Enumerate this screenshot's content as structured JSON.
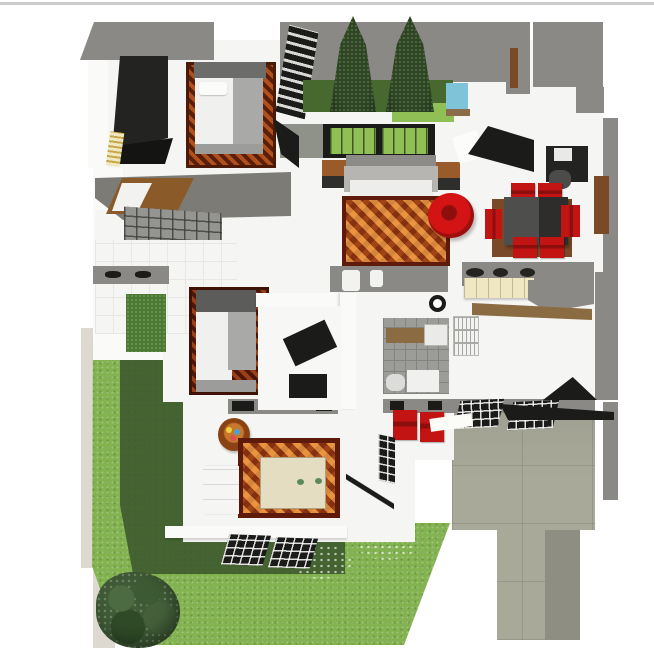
{
  "page": {
    "title": "3D house floor plan rendering",
    "description": "Bird's-eye axonometric render of a single-story house plan with furnished rooms, inner courtyard, garden lawn and driveway. No text is rendered in the image."
  },
  "colors": {
    "hairline": "#cccccc",
    "wallGray": "#8b8985",
    "wallGrayDark": "#7d7b76",
    "wallGreenGray": "#8f9289",
    "wallWhite": "#fafaf8",
    "floorWhite": "#f5f5f3",
    "floorTile": "#e7e7e3",
    "sidewalk": "#ddd9d0",
    "lawnLight": "#83b251",
    "lawnDark": "#47682f",
    "lawnShadow": "#3d5a2e",
    "grassCourtLight": "#8fbf55",
    "treeDark": "#2c4423",
    "treeDarker": "#1e3118",
    "pool": "#7fc3d9",
    "poolEdge": "#8a6b4a",
    "black": "#1b1b19",
    "charcoal": "#232321",
    "wardrobeSide": "#141412",
    "bedFrame": "#9c9c9a",
    "bedHead": "#6c6c6a",
    "mattress": "#f0f0ee",
    "blanket": "#a9a9a7",
    "rugRust": "#7a2c10",
    "rugOrange": "#b2491a",
    "rugBorder": "#5e1b0b",
    "sofaBack": "#8d8b88",
    "sofaBody": "#b7b5b2",
    "sofaSeat": "#ededeb",
    "woodBrown": "#9a5b2b",
    "deckBrown": "#8a5a28",
    "shelfBrown": "#8a6b42",
    "doorBrown": "#7a4a26",
    "matBrown": "#7a4a28",
    "red": "#c31414",
    "redDark": "#8e0e0e",
    "diningTableL": "#4e4e4c",
    "diningTableR": "#2f2d2b",
    "creamCounter": "#efe6c2",
    "applianceWhite": "#f2f2f0",
    "tileGray": "#9c9c98",
    "tileLine": "#83837f",
    "taupe": "#a9a99a",
    "taupeShadow": "#8e8e82",
    "bedCream": "#e5ddc2",
    "benchWhite": "#f5f5f3",
    "greenPatch": "#4c7a33",
    "bushGreen": "#3f5a36",
    "railGray": "#949490",
    "stripeGold": "#c8a84a"
  },
  "scene": {
    "rooms": [
      {
        "name": "bedroom-top-left",
        "contents": [
          "dark wardrobe",
          "double bed with white mattress and gray blanket",
          "rust patterned rug",
          "striped radiator"
        ]
      },
      {
        "name": "inner-courtyard",
        "contents": [
          "two conifer trees",
          "dark lawn strip",
          "light grass",
          "small blue pool",
          "dark trellis shelf"
        ]
      },
      {
        "name": "living-room",
        "contents": [
          "gray sofa with white seat",
          "two wooden side tables",
          "ornate orange rug",
          "round red armchair",
          "two windows with garden view",
          "black media unit",
          "desk with chair"
        ]
      },
      {
        "name": "dining-area",
        "contents": [
          "dark two-tone dining table",
          "six red chairs",
          "brown floor mat",
          "brown door in right wall"
        ]
      },
      {
        "name": "kitchen",
        "contents": [
          "gray counter band with three dark burners",
          "cream cabinet front",
          "gray corner worktop",
          "wooden shelf",
          "stacked white appliances"
        ]
      },
      {
        "name": "bathroom",
        "contents": [
          "gray tiled floor",
          "wooden bench",
          "white shower tray",
          "toilet",
          "washbasin",
          "black ring fixture"
        ]
      },
      {
        "name": "bedroom-middle",
        "contents": [
          "double bed with white mattress",
          "dark red rug",
          "walk-in closet with open black door",
          "black floor mat"
        ]
      },
      {
        "name": "light-well",
        "contents": [
          "small green planted courtyard",
          "gray wall with two dark vents"
        ]
      },
      {
        "name": "master-bedroom",
        "contents": [
          "large ornate orange rug",
          "cream platform bed with two green cushions",
          "white bench",
          "round wooden side table with flowers",
          "open door swing line"
        ]
      },
      {
        "name": "terrace",
        "contents": [
          "two red chairs",
          "black framed grid windows"
        ]
      },
      {
        "name": "porch-balcony",
        "contents": [
          "gray pitched roof",
          "brown wooden deck lounger with white cushion",
          "glass-grid railing",
          "white tiled floor"
        ]
      }
    ],
    "exterior": [
      "front lawn with shadow band",
      "flower speckles in grass",
      "round shrub at bottom left",
      "beige sidewalk strip on left",
      "taupe driveway with lower path",
      "black carport roof edges and slanted grid panels",
      "gray boundary fence on right",
      "thin gray page border line at very top"
    ]
  }
}
